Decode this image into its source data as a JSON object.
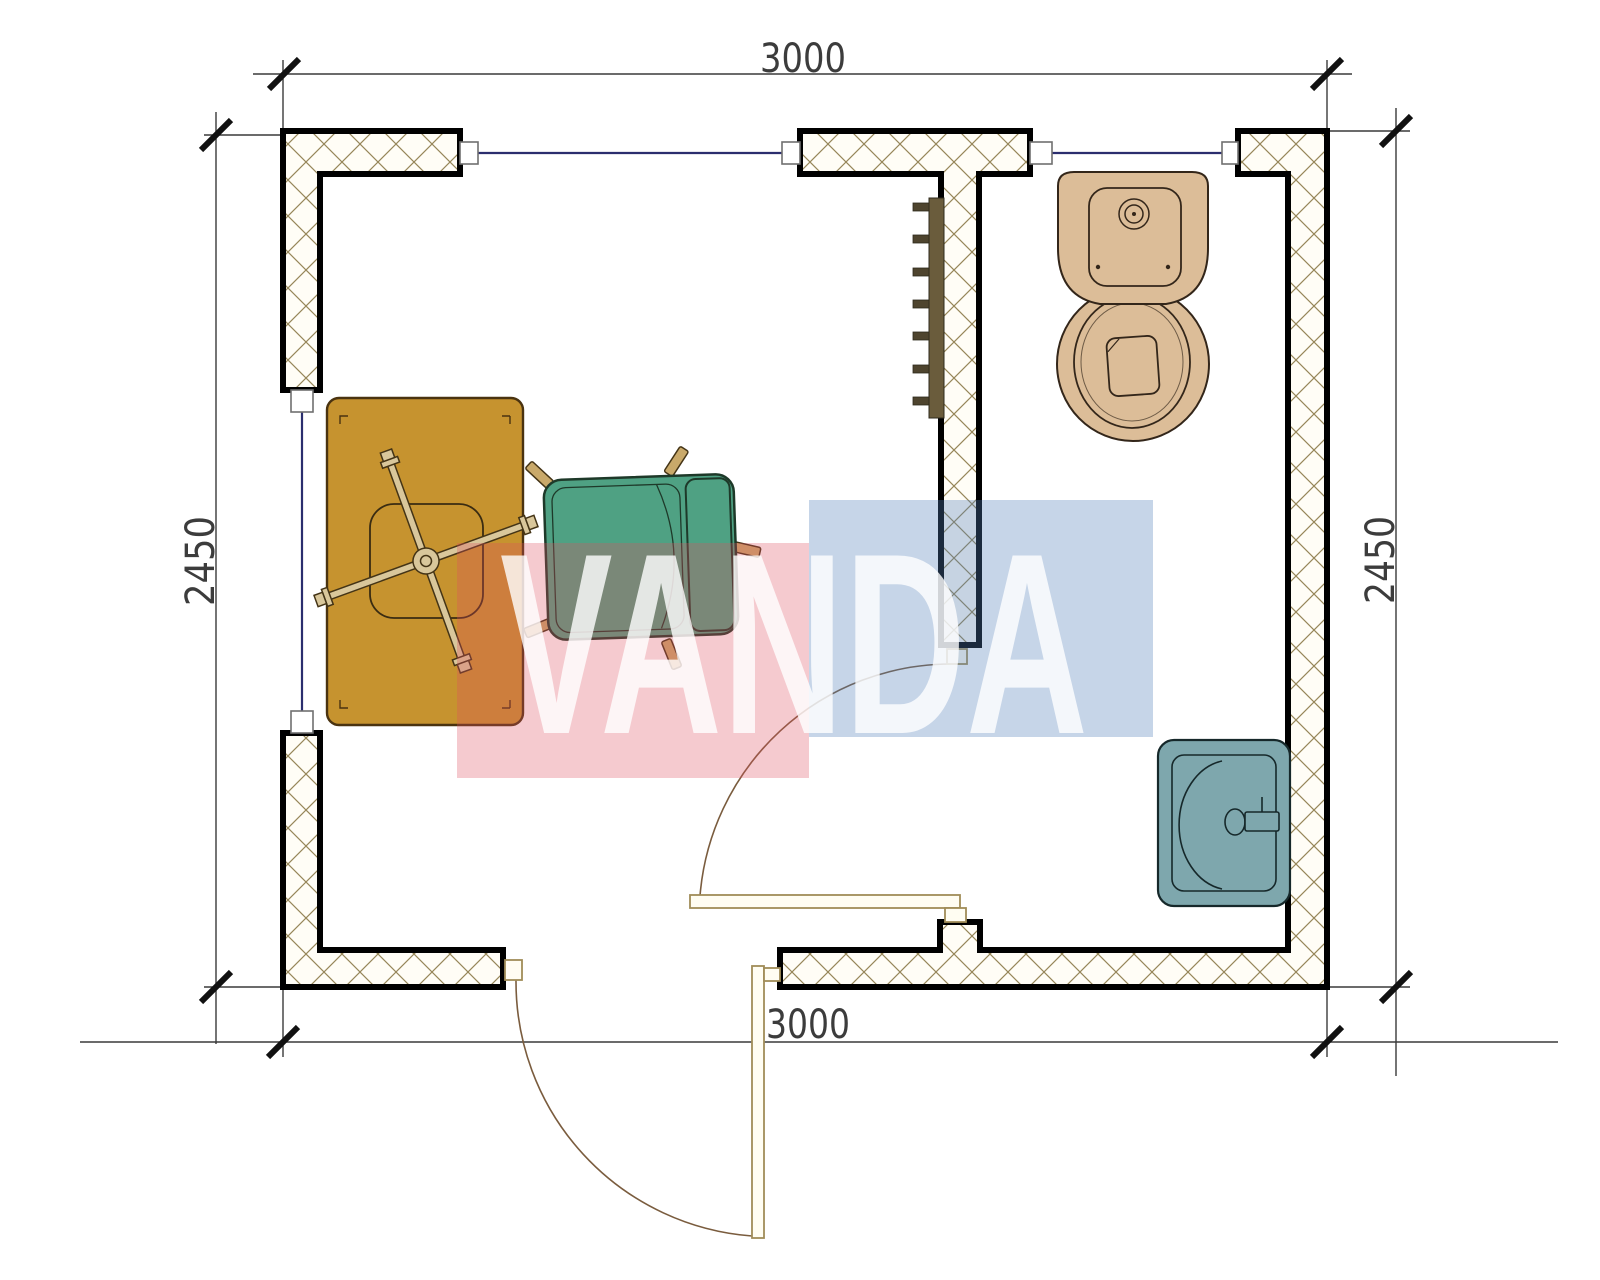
{
  "drawing": {
    "type": "floor-plan",
    "watermark": {
      "text": "VANDA",
      "red_block": "rgba(221,80,95,0.30)",
      "blue_block": "rgba(82,126,184,0.33)",
      "letters": "rgba(255,255,255,0.80)"
    },
    "dimensions": {
      "top": "3000",
      "bottom": "3000",
      "left": "2450",
      "right": "2450"
    },
    "palette": {
      "wall_hatch": "#968659",
      "wall_fill": "#fffdf6",
      "wall_outline": "#000000",
      "window_line": "#2b2e6e",
      "door_wood": "#fffdf2",
      "door_edge": "#a08c58",
      "swing_arc": "#7a5c3e",
      "desk": "#c6932f",
      "desk_edge": "#4a3310",
      "chair_base": "#d9c79b",
      "chair_base_edge": "#443416",
      "armchair": "#4fa183",
      "armchair_edge": "#1e3929",
      "armchair_legs": "#c9a96a",
      "toilet": "#dcbd98",
      "toilet_edge": "#33261a",
      "sink": "#7ea7ad",
      "sink_edge": "#16282a",
      "radiator": "#6a5c3c",
      "radiator_fin": "#4e442e",
      "dim_line": "#3a3a3a",
      "tick": "#111111"
    },
    "fixtures": [
      "desk",
      "desk-chair-base",
      "armchair",
      "radiator",
      "toilet",
      "sink",
      "interior-door",
      "exterior-door",
      "window-top-left",
      "window-top-right",
      "window-left"
    ]
  }
}
